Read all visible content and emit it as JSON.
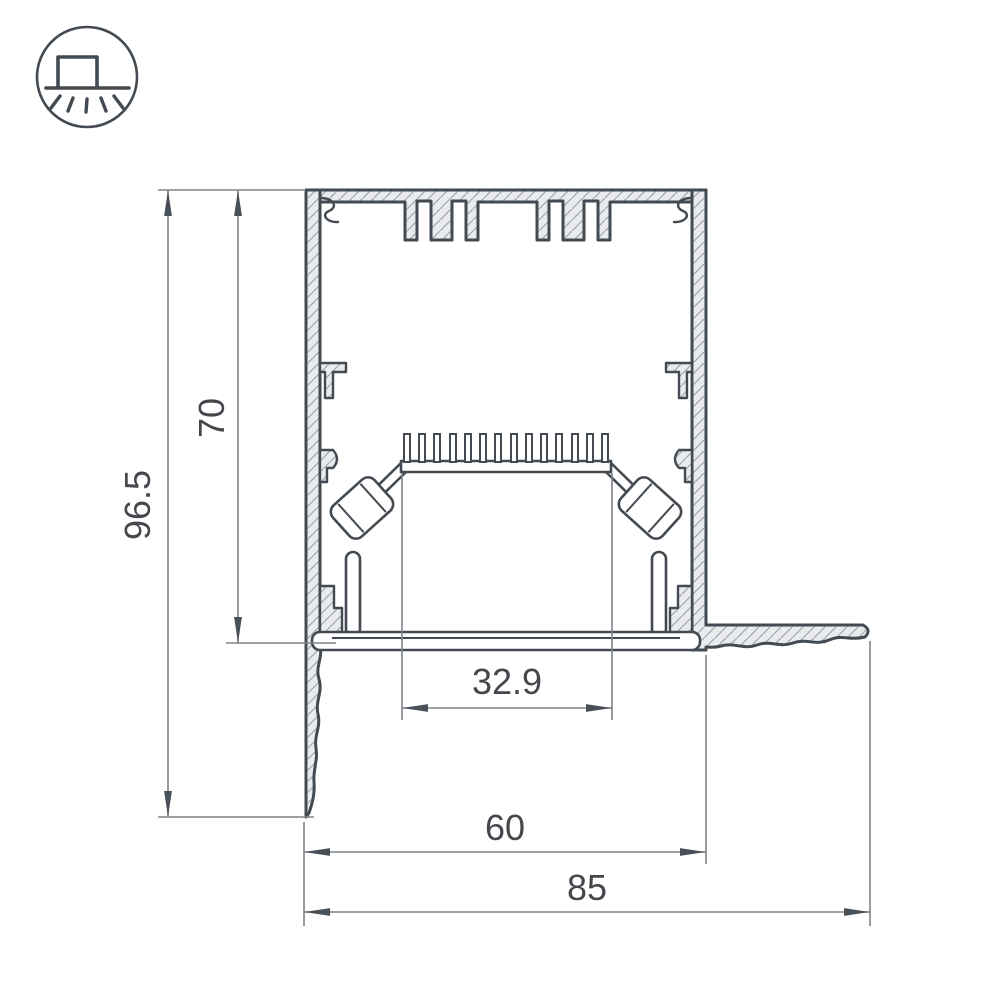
{
  "colors": {
    "line": "#434a51",
    "alu": "#e9ebec",
    "hatch": "#9ba1a7",
    "dim": "#7d848a",
    "arrow": "#4a5057",
    "text": "#44484d"
  },
  "icons": {
    "badge": "recessed-ceiling-profile-icon"
  },
  "dimensions": {
    "height_total": "96.5",
    "height_body": "70",
    "width_inner": "32.9",
    "width_body": "60",
    "width_total": "85"
  }
}
